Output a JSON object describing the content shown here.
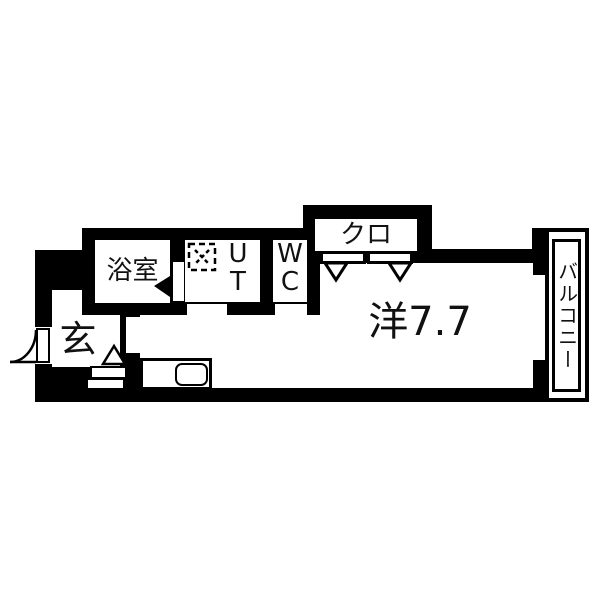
{
  "floorplan": {
    "title": "apartment-floor-plan",
    "colors": {
      "wall": "#000000",
      "floor": "#ffffff"
    },
    "rooms": {
      "bathroom": {
        "label": "浴室"
      },
      "utility": {
        "line1": "U",
        "line2": "T"
      },
      "toilet": {
        "line1": "W",
        "line2": "C"
      },
      "closet": {
        "label": "クロ"
      },
      "main_room": {
        "label": "洋7.7"
      },
      "balcony": {
        "label": "バルコニー"
      },
      "entrance": {
        "label": "玄"
      }
    },
    "icons": {
      "entry_door": "door-swing-arc",
      "bathroom_door": "triangle-left",
      "entry_step": "triangle-up",
      "closet_doors": "triangle-down",
      "washer_pan": "dashed-square-x",
      "kitchen_sink": "rounded-rect"
    }
  }
}
